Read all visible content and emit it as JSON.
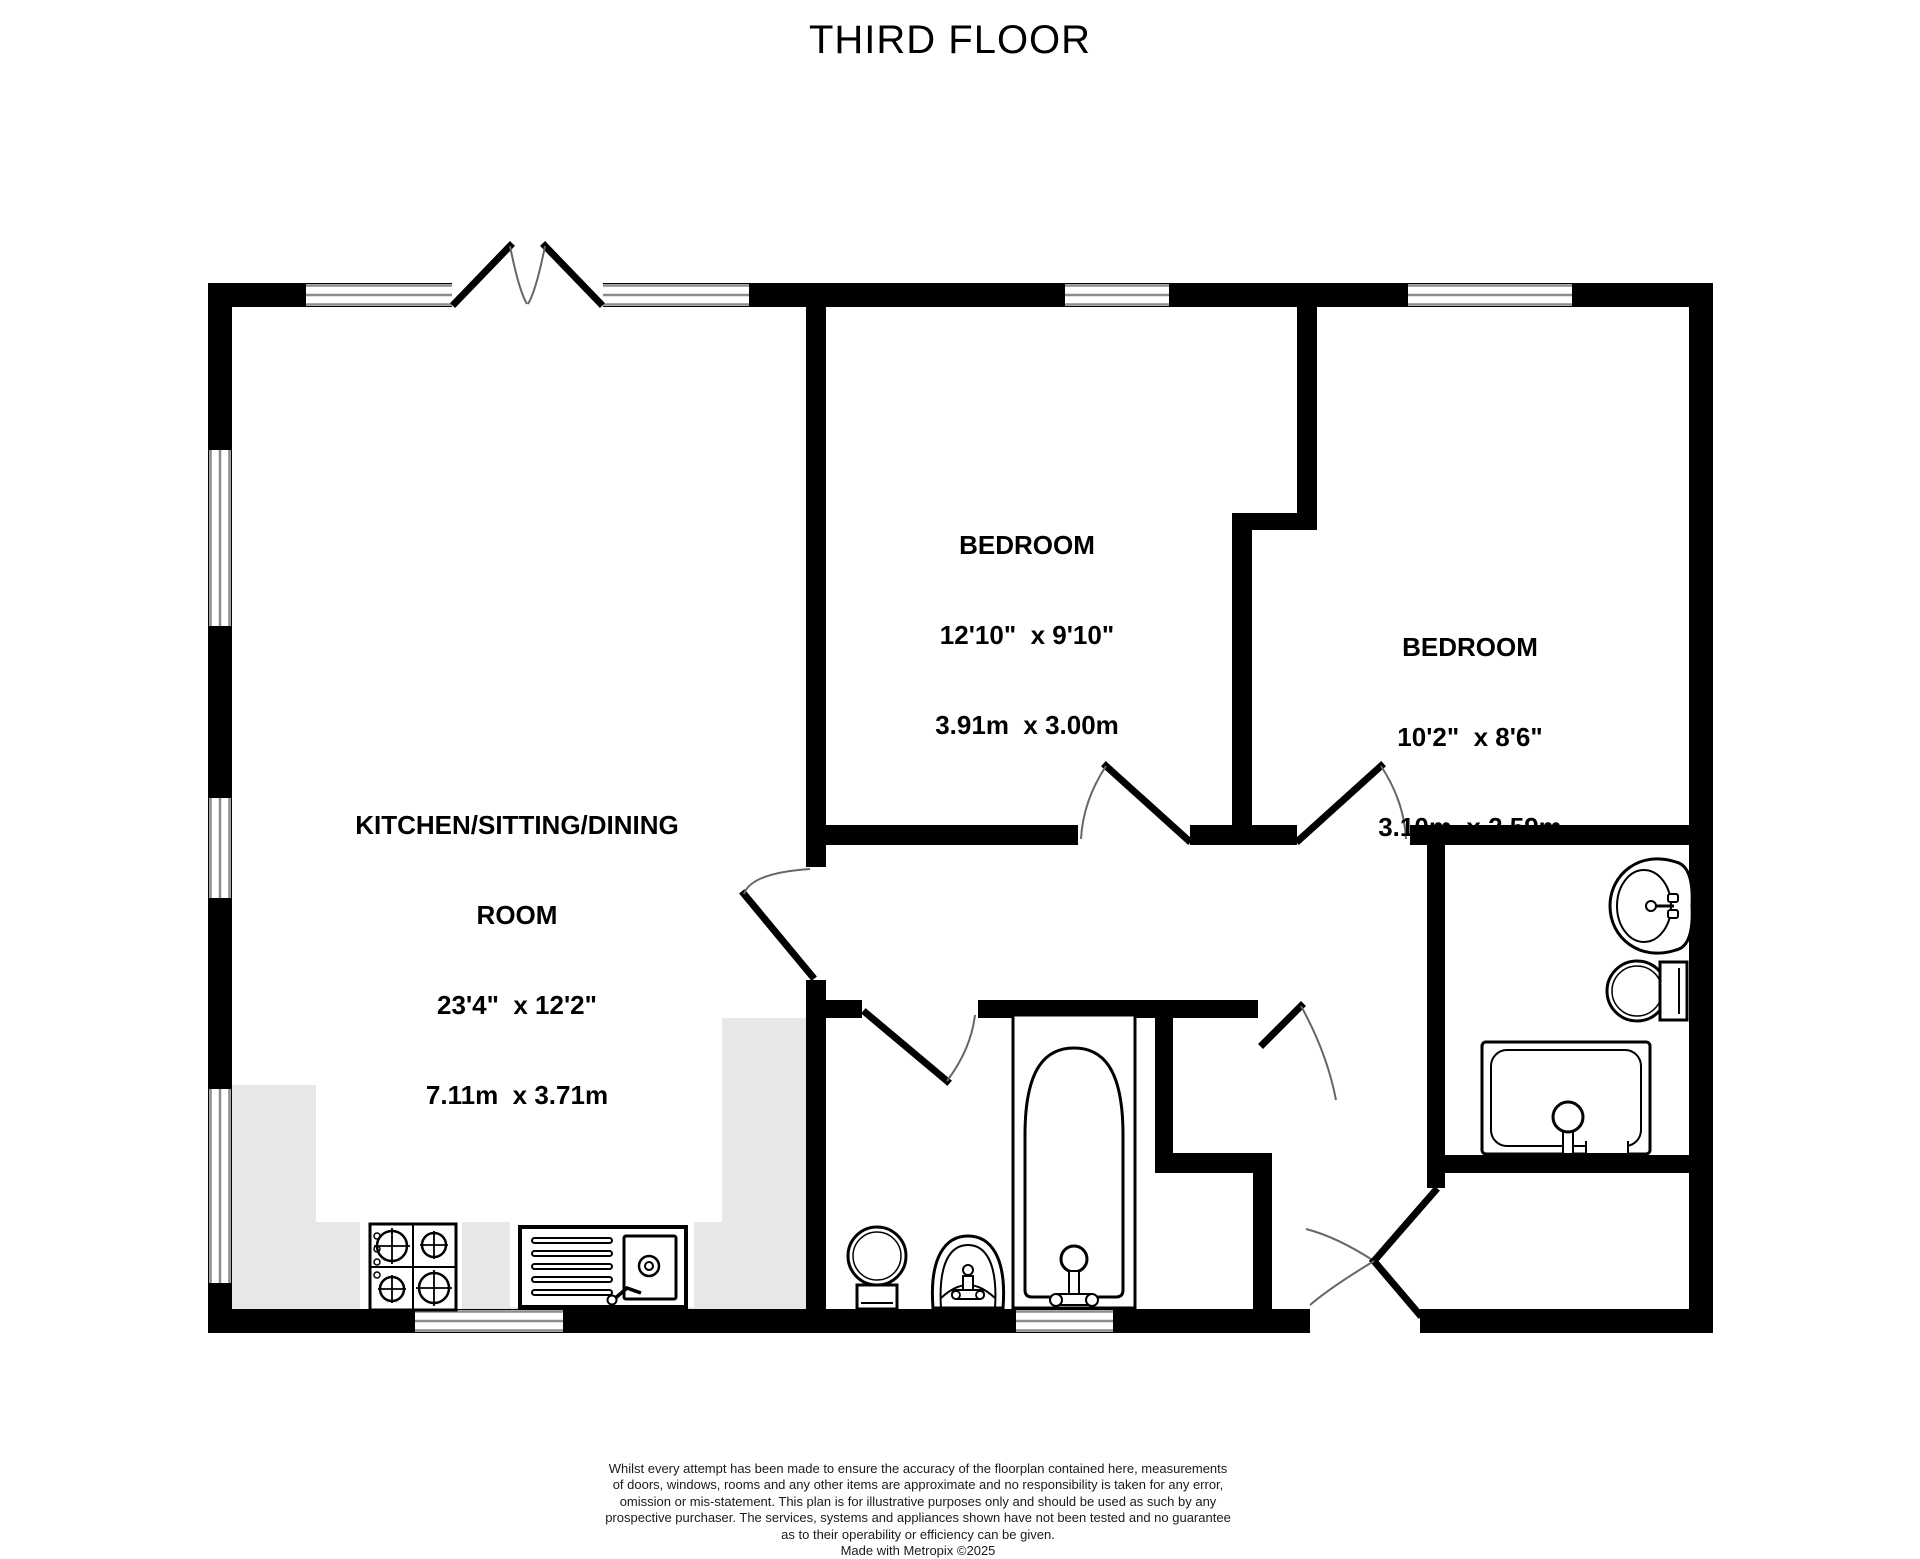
{
  "title": "THIRD FLOOR",
  "rooms": {
    "kitchen": {
      "name_line1": "KITCHEN/SITTING/DINING",
      "name_line2": "ROOM",
      "size_imperial": "23'4\"  x 12'2\"",
      "size_metric": "7.11m  x 3.71m"
    },
    "bedroom1": {
      "name": "BEDROOM",
      "size_imperial": "12'10\"  x 9'10\"",
      "size_metric": "3.91m  x 3.00m"
    },
    "bedroom2": {
      "name": "BEDROOM",
      "size_imperial": "10'2\"  x 8'6\"",
      "size_metric": "3.10m  x 2.59m"
    }
  },
  "disclaimer": {
    "line1": "Whilst every attempt has been made to ensure the accuracy of the floorplan contained here, measurements",
    "line2": "of doors, windows, rooms and any other items are approximate and no responsibility is taken for any error,",
    "line3": "omission or mis-statement. This plan is for illustrative purposes only and should be used as such by any",
    "line4": "prospective purchaser. The services, systems and appliances shown have not been tested and no guarantee",
    "line5": "as to their operability or efficiency can be given.",
    "credit": "Made with Metropix ©2025"
  },
  "colors": {
    "wall": "#000000",
    "background": "#ffffff",
    "kitchen_counter": "#e7e7e7",
    "window_line": "#8c8c8c",
    "door_arc": "#666666",
    "disclaimer_text": "#1a1a1a"
  },
  "fixtures": {
    "kitchen": [
      "hob",
      "sink-with-drainer"
    ],
    "bathroom": [
      "bathtub",
      "toilet",
      "pedestal-basin"
    ],
    "shower_room": [
      "washbasin",
      "toilet",
      "shower-enclosure"
    ]
  }
}
